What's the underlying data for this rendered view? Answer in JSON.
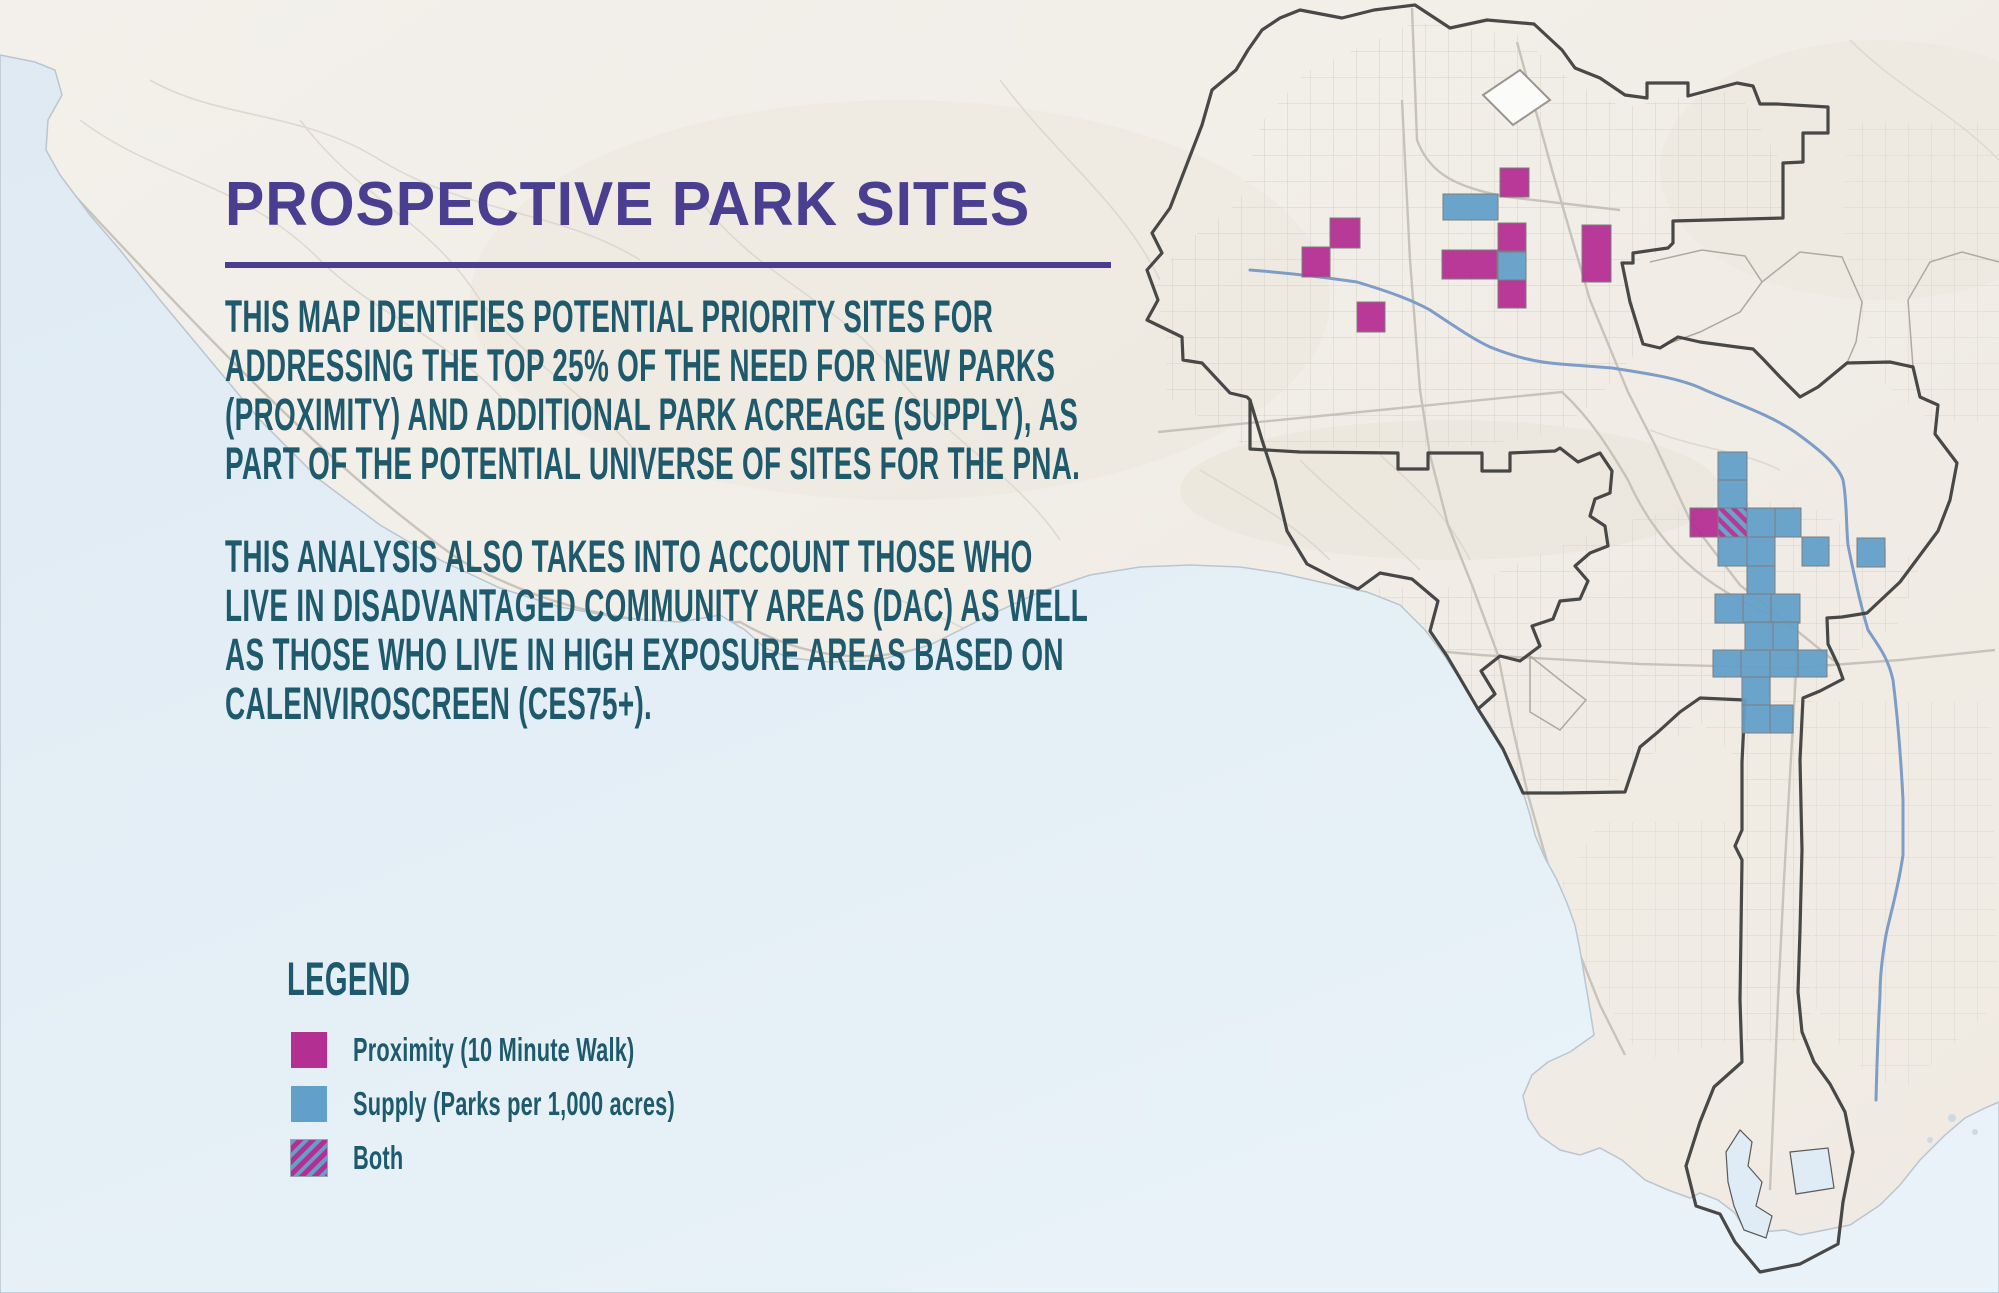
{
  "title": {
    "text": "PROSPECTIVE PARK SITES"
  },
  "intro": {
    "lines": [
      "THIS MAP IDENTIFIES POTENTIAL PRIORITY SITES FOR",
      "ADDRESSING THE TOP 25% OF THE NEED FOR NEW PARKS",
      "(PROXIMITY) AND ADDITIONAL PARK ACREAGE (SUPPLY), AS",
      "PART OF THE POTENTIAL UNIVERSE OF SITES FOR THE PNA."
    ]
  },
  "analysis": {
    "lines": [
      "THIS ANALYSIS ALSO TAKES INTO ACCOUNT THOSE WHO",
      "LIVE IN DISADVANTAGED COMMUNITY AREAS (DAC) AS WELL",
      "AS THOSE WHO LIVE IN HIGH EXPOSURE AREAS BASED ON",
      "CALENVIROSCREEN (CES75+)."
    ]
  },
  "legend": {
    "heading": "LEGEND",
    "items": [
      {
        "type": "proximity",
        "label": "Proximity (10 Minute Walk)"
      },
      {
        "type": "supply",
        "label": "Supply (Parks per 1,000 acres)"
      },
      {
        "type": "both",
        "label": "Both"
      }
    ]
  },
  "colors": {
    "proximity": "#b42f92",
    "supply": "#63a0c9",
    "both_stripe": "#b42f92",
    "body_teal": "#1e5a6c",
    "title_purple": "#493e90",
    "land": "#f1ede6",
    "ocean": "#e2edf5",
    "boundary": "#3a3a3a",
    "river": "#7d9dc6"
  },
  "map": {
    "description": "City of Los Angeles outline map with prospective park site grid cells",
    "sites": [
      {
        "type": "proximity",
        "x": 1500,
        "y": 168,
        "w": 29,
        "h": 29
      },
      {
        "type": "supply",
        "x": 1443,
        "y": 194,
        "w": 55,
        "h": 26
      },
      {
        "type": "proximity",
        "x": 1330,
        "y": 218,
        "w": 30,
        "h": 30
      },
      {
        "type": "proximity",
        "x": 1498,
        "y": 223,
        "w": 28,
        "h": 28
      },
      {
        "type": "proximity",
        "x": 1302,
        "y": 247,
        "w": 28,
        "h": 30
      },
      {
        "type": "proximity",
        "x": 1442,
        "y": 250,
        "w": 55,
        "h": 29
      },
      {
        "type": "supply",
        "x": 1498,
        "y": 252,
        "w": 28,
        "h": 28
      },
      {
        "type": "proximity",
        "x": 1582,
        "y": 225,
        "w": 29,
        "h": 57
      },
      {
        "type": "proximity",
        "x": 1498,
        "y": 280,
        "w": 28,
        "h": 28
      },
      {
        "type": "proximity",
        "x": 1357,
        "y": 302,
        "w": 28,
        "h": 30
      },
      {
        "type": "supply",
        "x": 1718,
        "y": 452,
        "w": 29,
        "h": 28
      },
      {
        "type": "supply",
        "x": 1718,
        "y": 480,
        "w": 29,
        "h": 28
      },
      {
        "type": "proximity",
        "x": 1690,
        "y": 508,
        "w": 28,
        "h": 29
      },
      {
        "type": "both",
        "x": 1718,
        "y": 508,
        "w": 29,
        "h": 29
      },
      {
        "type": "supply",
        "x": 1747,
        "y": 508,
        "w": 28,
        "h": 29
      },
      {
        "type": "supply",
        "x": 1775,
        "y": 508,
        "w": 26,
        "h": 29
      },
      {
        "type": "supply",
        "x": 1718,
        "y": 537,
        "w": 29,
        "h": 29
      },
      {
        "type": "supply",
        "x": 1747,
        "y": 537,
        "w": 28,
        "h": 29
      },
      {
        "type": "supply",
        "x": 1802,
        "y": 537,
        "w": 27,
        "h": 29
      },
      {
        "type": "supply",
        "x": 1857,
        "y": 538,
        "w": 28,
        "h": 29
      },
      {
        "type": "supply",
        "x": 1747,
        "y": 566,
        "w": 28,
        "h": 28
      },
      {
        "type": "supply",
        "x": 1715,
        "y": 594,
        "w": 28,
        "h": 29
      },
      {
        "type": "supply",
        "x": 1743,
        "y": 594,
        "w": 28,
        "h": 29
      },
      {
        "type": "supply",
        "x": 1771,
        "y": 594,
        "w": 29,
        "h": 29
      },
      {
        "type": "supply",
        "x": 1745,
        "y": 622,
        "w": 28,
        "h": 28
      },
      {
        "type": "supply",
        "x": 1773,
        "y": 622,
        "w": 25,
        "h": 28
      },
      {
        "type": "supply",
        "x": 1713,
        "y": 650,
        "w": 28,
        "h": 27
      },
      {
        "type": "supply",
        "x": 1741,
        "y": 650,
        "w": 29,
        "h": 27
      },
      {
        "type": "supply",
        "x": 1770,
        "y": 650,
        "w": 28,
        "h": 27
      },
      {
        "type": "supply",
        "x": 1798,
        "y": 650,
        "w": 29,
        "h": 27
      },
      {
        "type": "supply",
        "x": 1742,
        "y": 677,
        "w": 28,
        "h": 28
      },
      {
        "type": "supply",
        "x": 1742,
        "y": 705,
        "w": 28,
        "h": 28
      },
      {
        "type": "supply",
        "x": 1770,
        "y": 705,
        "w": 23,
        "h": 28
      }
    ]
  }
}
